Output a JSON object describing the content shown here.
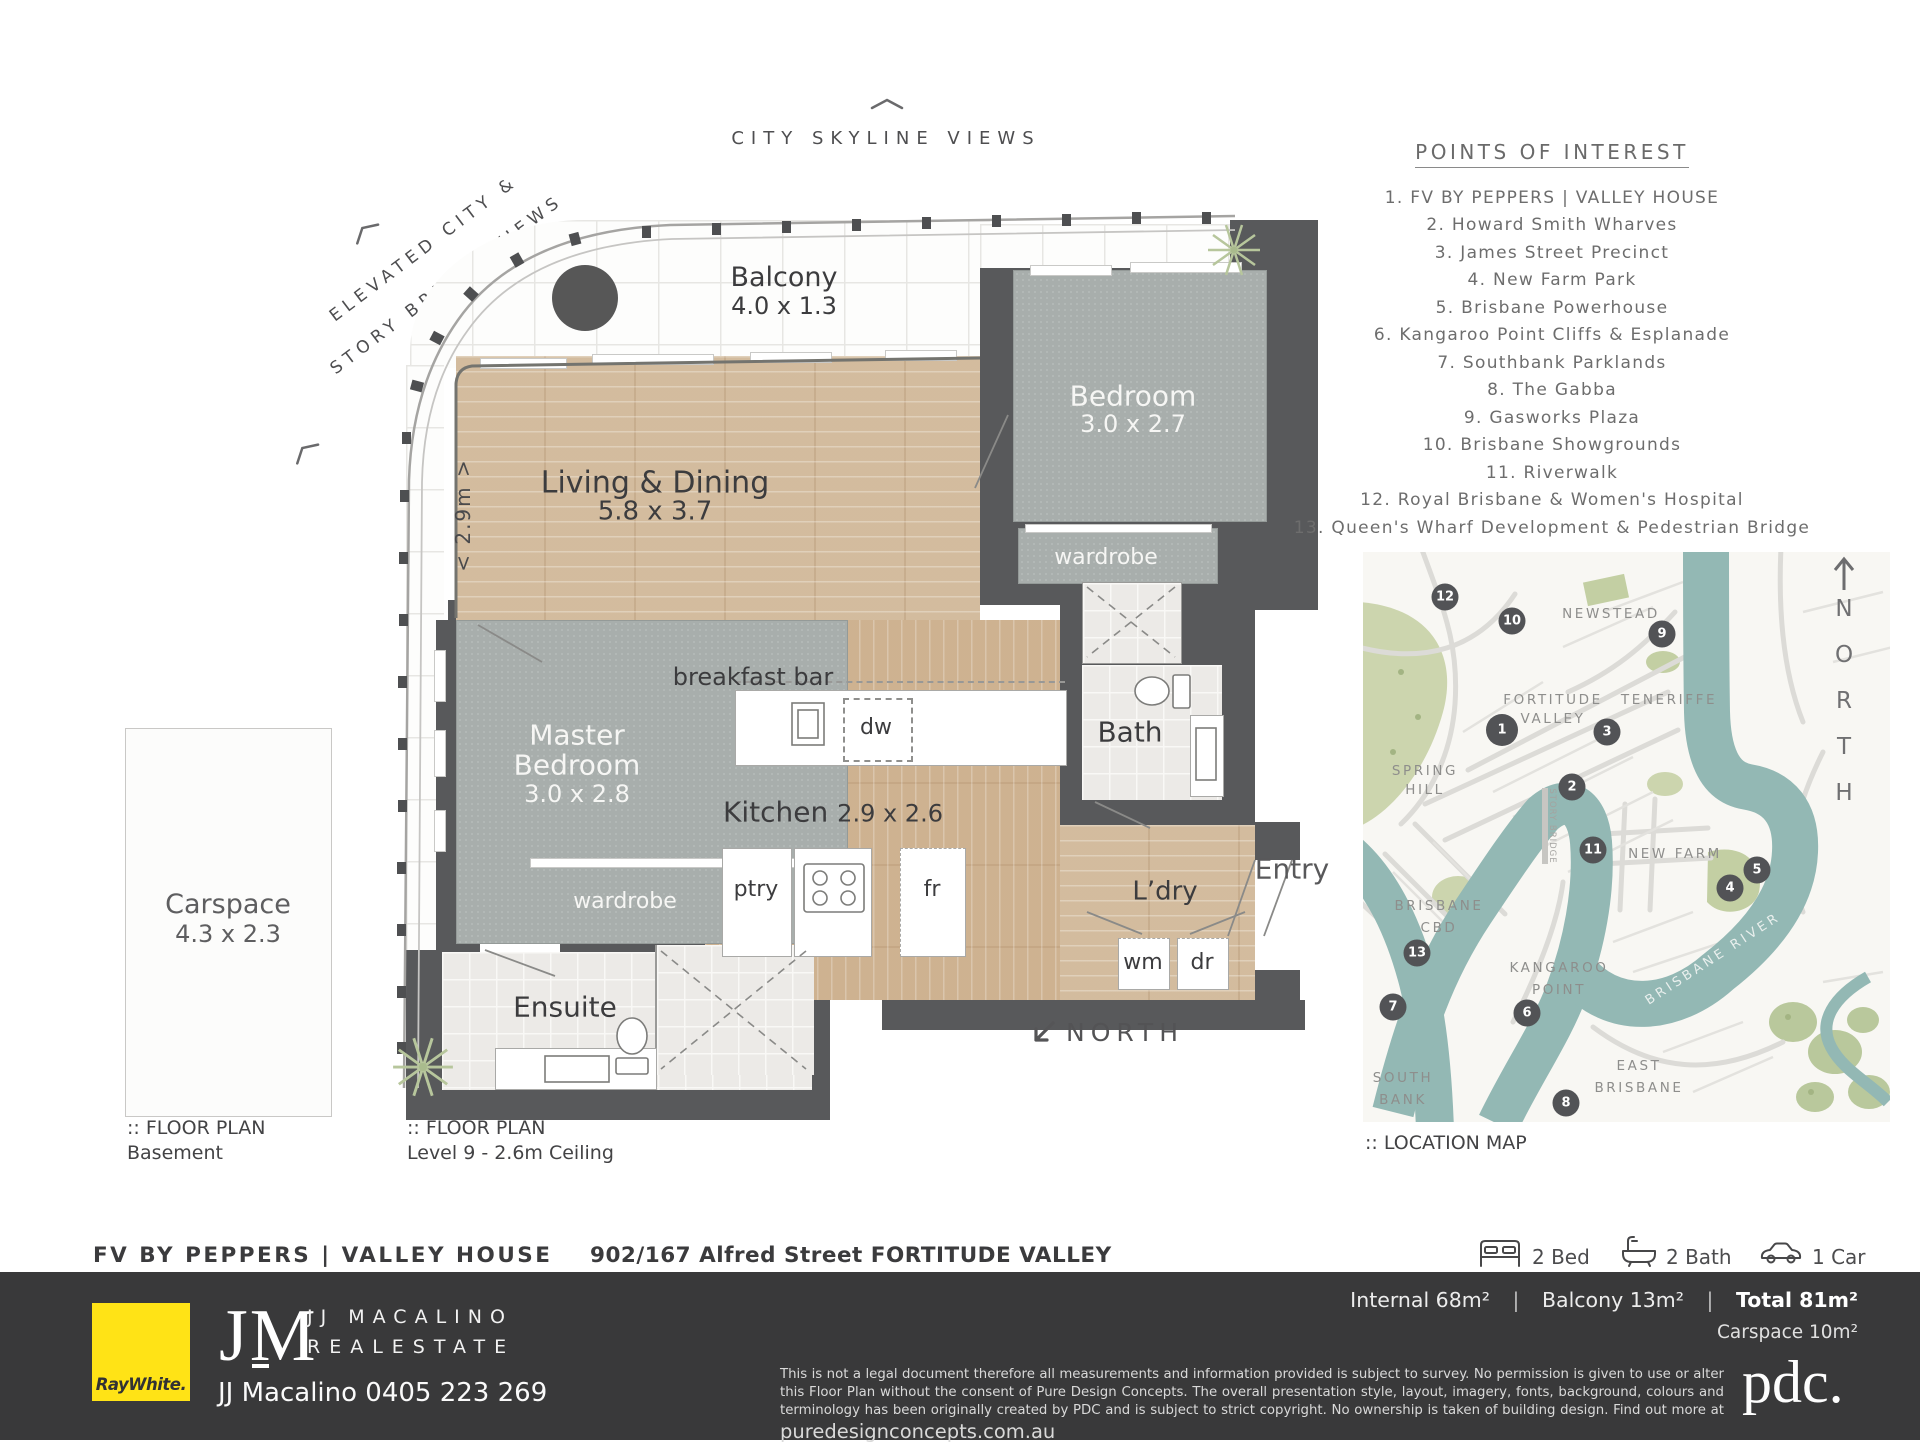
{
  "header": {
    "city_views": "CITY SKYLINE VIEWS",
    "elevated_line1": "ELEVATED CITY &",
    "elevated_line2": "STORY BRIDGE VIEWS"
  },
  "plan": {
    "balcony_name": "Balcony",
    "balcony_dims": "4.0 x 1.3",
    "living_name": "Living & Dining",
    "living_dims": "5.8 x 3.7",
    "bedroom_name": "Bedroom",
    "bedroom_dims": "3.0 x 2.7",
    "master_name1": "Master",
    "master_name2": "Bedroom",
    "master_dims": "3.0 x 2.8",
    "kitchen_name": "Kitchen",
    "kitchen_dims": "2.9 x 2.6",
    "bath": "Bath",
    "ensuite": "Ensuite",
    "laundry": "L’dry",
    "entry": "Entry",
    "wardrobe_master": "wardrobe",
    "wardrobe_bedroom": "wardrobe",
    "breakfast_bar": "breakfast bar",
    "pantry": "ptry",
    "dishwasher": "dw",
    "fridge": "fr",
    "washing_machine": "wm",
    "dryer": "dr",
    "dim_note": "< 2.9m >",
    "north_label": "NORTH"
  },
  "carspace": {
    "name": "Carspace",
    "dims": "4.3 x 2.3",
    "plan_label": ":: FLOOR PLAN",
    "plan_sub": "Basement"
  },
  "level": {
    "plan_label": ":: FLOOR PLAN",
    "plan_sub": "Level 9 - 2.6m Ceiling"
  },
  "poi": {
    "title": "POINTS OF INTEREST",
    "items": [
      "1. FV BY PEPPERS  |  VALLEY HOUSE",
      "2. Howard Smith Wharves",
      "3. James Street Precinct",
      "4. New Farm Park",
      "5. Brisbane Powerhouse",
      "6. Kangaroo Point Cliffs & Esplanade",
      "7. Southbank Parklands",
      "8. The Gabba",
      "9. Gasworks Plaza",
      "10. Brisbane Showgrounds",
      "11. Riverwalk",
      "12. Royal Brisbane & Women's Hospital",
      "13. Queen's Wharf Development & Pedestrian Bridge"
    ]
  },
  "map": {
    "caption": ":: LOCATION MAP",
    "north": "NORTH",
    "river": "BRISBANE RIVER",
    "bridge": "STORY BRIDGE",
    "suburbs": {
      "newstead": "NEWSTEAD",
      "fortitude1": "FORTITUDE",
      "fortitude2": "VALLEY",
      "teneriffe": "TENERIFFE",
      "spring1": "SPRING",
      "spring2": "HILL",
      "cbd1": "BRISBANE",
      "cbd2": "CBD",
      "newfarm": "NEW FARM",
      "kangaroo1": "KANGAROO",
      "kangaroo2": "POINT",
      "south1": "SOUTH",
      "south2": "BANK",
      "east1": "EAST",
      "east2": "BRISBANE"
    },
    "markers": [
      "1",
      "2",
      "3",
      "4",
      "5",
      "6",
      "7",
      "8",
      "9",
      "10",
      "11",
      "12",
      "13"
    ]
  },
  "property": {
    "name": "FV BY PEPPERS  |  VALLEY HOUSE",
    "address": "902/167 Alfred Street FORTITUDE VALLEY",
    "beds": "2 Bed",
    "baths": "2 Bath",
    "cars": "1 Car"
  },
  "footer": {
    "raywhite": "RayWhite.",
    "jm": "JM",
    "agency_line1": "JJ MACALINO",
    "agency_line2": "REALESTATE",
    "agent": "JJ Macalino  0405 223 269",
    "internal": "Internal 68m²",
    "balcony": "Balcony 13m²",
    "total": "Total 81m²",
    "carspace": "Carspace 10m²",
    "sep": "|",
    "disclaimer": "This is not a legal document therefore all measurements and information provided is subject to survey. No permission is given to use or alter this Floor Plan without the consent of Pure Design Concepts. The overall presentation style, layout, imagery, fonts, background, colours and terminology has been originally created by PDC and is subject to strict copyright. No ownership is taken of building design. Find out more at ",
    "website": "puredesignconcepts.com.au",
    "pdc": "pdc."
  }
}
